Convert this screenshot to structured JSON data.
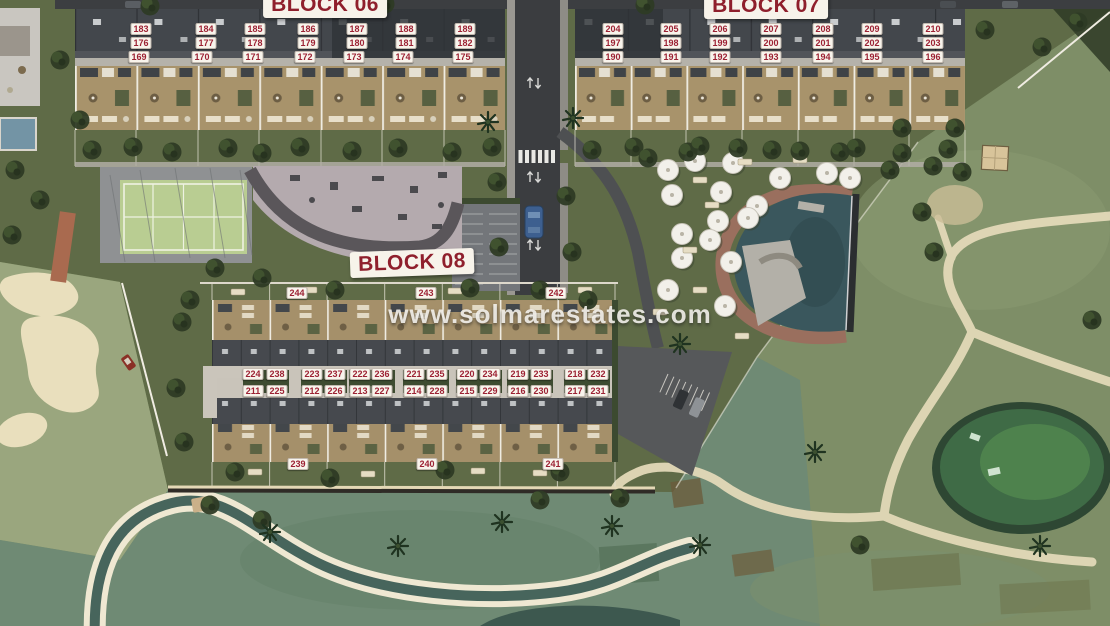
{
  "watermark": "www.solmarestates.com",
  "colors": {
    "label_text": "#9c2133",
    "label_bg": "#f8f4ec",
    "grass": "#5f6b47",
    "golf": "#7e8e67",
    "pale_fairway": "#9aa67e",
    "roof": "#43474c",
    "terrace": "#a8936b",
    "road": "#3b3d40",
    "pool_water": "#3a575d",
    "pool_deck": "#9a6f5e",
    "path": "#e3d9b8",
    "bunker_sand": "#e9dfbd",
    "creek_water": "#47655c",
    "court_green": "#b9cd92",
    "paving": "#b4aaae"
  },
  "block_labels": [
    {
      "text": "BLOCK 06",
      "x": 325,
      "y": 5,
      "rot": 0
    },
    {
      "text": "BLOCK 07",
      "x": 766,
      "y": 6,
      "rot": 0
    },
    {
      "text": "BLOCK 08",
      "x": 412,
      "y": 263,
      "rot": -2
    }
  ],
  "unit_labels": [
    {
      "block": "BLOCK 06",
      "n": "183",
      "x": 141,
      "y": 29
    },
    {
      "block": "BLOCK 06",
      "n": "184",
      "x": 206,
      "y": 29
    },
    {
      "block": "BLOCK 06",
      "n": "185",
      "x": 255,
      "y": 29
    },
    {
      "block": "BLOCK 06",
      "n": "186",
      "x": 308,
      "y": 29
    },
    {
      "block": "BLOCK 06",
      "n": "187",
      "x": 357,
      "y": 29
    },
    {
      "block": "BLOCK 06",
      "n": "188",
      "x": 406,
      "y": 29
    },
    {
      "block": "BLOCK 06",
      "n": "189",
      "x": 465,
      "y": 29
    },
    {
      "block": "BLOCK 06",
      "n": "176",
      "x": 141,
      "y": 43
    },
    {
      "block": "BLOCK 06",
      "n": "177",
      "x": 206,
      "y": 43
    },
    {
      "block": "BLOCK 06",
      "n": "178",
      "x": 255,
      "y": 43
    },
    {
      "block": "BLOCK 06",
      "n": "179",
      "x": 308,
      "y": 43
    },
    {
      "block": "BLOCK 06",
      "n": "180",
      "x": 357,
      "y": 43
    },
    {
      "block": "BLOCK 06",
      "n": "181",
      "x": 406,
      "y": 43
    },
    {
      "block": "BLOCK 06",
      "n": "182",
      "x": 465,
      "y": 43
    },
    {
      "block": "BLOCK 06",
      "n": "169",
      "x": 139,
      "y": 57
    },
    {
      "block": "BLOCK 06",
      "n": "170",
      "x": 202,
      "y": 57
    },
    {
      "block": "BLOCK 06",
      "n": "171",
      "x": 253,
      "y": 57
    },
    {
      "block": "BLOCK 06",
      "n": "172",
      "x": 305,
      "y": 57
    },
    {
      "block": "BLOCK 06",
      "n": "173",
      "x": 354,
      "y": 57
    },
    {
      "block": "BLOCK 06",
      "n": "174",
      "x": 403,
      "y": 57
    },
    {
      "block": "BLOCK 06",
      "n": "175",
      "x": 463,
      "y": 57
    },
    {
      "block": "BLOCK 07",
      "n": "204",
      "x": 613,
      "y": 29
    },
    {
      "block": "BLOCK 07",
      "n": "205",
      "x": 671,
      "y": 29
    },
    {
      "block": "BLOCK 07",
      "n": "206",
      "x": 720,
      "y": 29
    },
    {
      "block": "BLOCK 07",
      "n": "207",
      "x": 771,
      "y": 29
    },
    {
      "block": "BLOCK 07",
      "n": "208",
      "x": 823,
      "y": 29
    },
    {
      "block": "BLOCK 07",
      "n": "209",
      "x": 872,
      "y": 29
    },
    {
      "block": "BLOCK 07",
      "n": "210",
      "x": 933,
      "y": 29
    },
    {
      "block": "BLOCK 07",
      "n": "197",
      "x": 613,
      "y": 43
    },
    {
      "block": "BLOCK 07",
      "n": "198",
      "x": 671,
      "y": 43
    },
    {
      "block": "BLOCK 07",
      "n": "199",
      "x": 720,
      "y": 43
    },
    {
      "block": "BLOCK 07",
      "n": "200",
      "x": 771,
      "y": 43
    },
    {
      "block": "BLOCK 07",
      "n": "201",
      "x": 823,
      "y": 43
    },
    {
      "block": "BLOCK 07",
      "n": "202",
      "x": 872,
      "y": 43
    },
    {
      "block": "BLOCK 07",
      "n": "203",
      "x": 933,
      "y": 43
    },
    {
      "block": "BLOCK 07",
      "n": "190",
      "x": 613,
      "y": 57
    },
    {
      "block": "BLOCK 07",
      "n": "191",
      "x": 671,
      "y": 57
    },
    {
      "block": "BLOCK 07",
      "n": "192",
      "x": 720,
      "y": 57
    },
    {
      "block": "BLOCK 07",
      "n": "193",
      "x": 771,
      "y": 57
    },
    {
      "block": "BLOCK 07",
      "n": "194",
      "x": 823,
      "y": 57
    },
    {
      "block": "BLOCK 07",
      "n": "195",
      "x": 872,
      "y": 57
    },
    {
      "block": "BLOCK 07",
      "n": "196",
      "x": 933,
      "y": 57
    },
    {
      "block": "BLOCK 08",
      "n": "224",
      "x": 253,
      "y": 374
    },
    {
      "block": "BLOCK 08",
      "n": "238",
      "x": 277,
      "y": 374
    },
    {
      "block": "BLOCK 08",
      "n": "223",
      "x": 312,
      "y": 374
    },
    {
      "block": "BLOCK 08",
      "n": "237",
      "x": 335,
      "y": 374
    },
    {
      "block": "BLOCK 08",
      "n": "222",
      "x": 360,
      "y": 374
    },
    {
      "block": "BLOCK 08",
      "n": "236",
      "x": 382,
      "y": 374
    },
    {
      "block": "BLOCK 08",
      "n": "221",
      "x": 414,
      "y": 374
    },
    {
      "block": "BLOCK 08",
      "n": "235",
      "x": 437,
      "y": 374
    },
    {
      "block": "BLOCK 08",
      "n": "220",
      "x": 467,
      "y": 374
    },
    {
      "block": "BLOCK 08",
      "n": "234",
      "x": 490,
      "y": 374
    },
    {
      "block": "BLOCK 08",
      "n": "219",
      "x": 518,
      "y": 374
    },
    {
      "block": "BLOCK 08",
      "n": "233",
      "x": 541,
      "y": 374
    },
    {
      "block": "BLOCK 08",
      "n": "218",
      "x": 575,
      "y": 374
    },
    {
      "block": "BLOCK 08",
      "n": "232",
      "x": 598,
      "y": 374
    },
    {
      "block": "BLOCK 08",
      "n": "211",
      "x": 253,
      "y": 391
    },
    {
      "block": "BLOCK 08",
      "n": "225",
      "x": 277,
      "y": 391
    },
    {
      "block": "BLOCK 08",
      "n": "212",
      "x": 312,
      "y": 391
    },
    {
      "block": "BLOCK 08",
      "n": "226",
      "x": 335,
      "y": 391
    },
    {
      "block": "BLOCK 08",
      "n": "213",
      "x": 360,
      "y": 391
    },
    {
      "block": "BLOCK 08",
      "n": "227",
      "x": 382,
      "y": 391
    },
    {
      "block": "BLOCK 08",
      "n": "214",
      "x": 414,
      "y": 391
    },
    {
      "block": "BLOCK 08",
      "n": "228",
      "x": 437,
      "y": 391
    },
    {
      "block": "BLOCK 08",
      "n": "215",
      "x": 467,
      "y": 391
    },
    {
      "block": "BLOCK 08",
      "n": "229",
      "x": 490,
      "y": 391
    },
    {
      "block": "BLOCK 08",
      "n": "216",
      "x": 518,
      "y": 391
    },
    {
      "block": "BLOCK 08",
      "n": "230",
      "x": 541,
      "y": 391
    },
    {
      "block": "BLOCK 08",
      "n": "217",
      "x": 575,
      "y": 391
    },
    {
      "block": "BLOCK 08",
      "n": "231",
      "x": 598,
      "y": 391
    },
    {
      "block": "BLOCK 08",
      "n": "244",
      "x": 297,
      "y": 293
    },
    {
      "block": "BLOCK 08",
      "n": "243",
      "x": 426,
      "y": 293
    },
    {
      "block": "BLOCK 08",
      "n": "242",
      "x": 556,
      "y": 293
    },
    {
      "block": "BLOCK 08",
      "n": "239",
      "x": 298,
      "y": 464
    },
    {
      "block": "BLOCK 08",
      "n": "240",
      "x": 427,
      "y": 464
    },
    {
      "block": "BLOCK 08",
      "n": "241",
      "x": 553,
      "y": 464
    }
  ]
}
